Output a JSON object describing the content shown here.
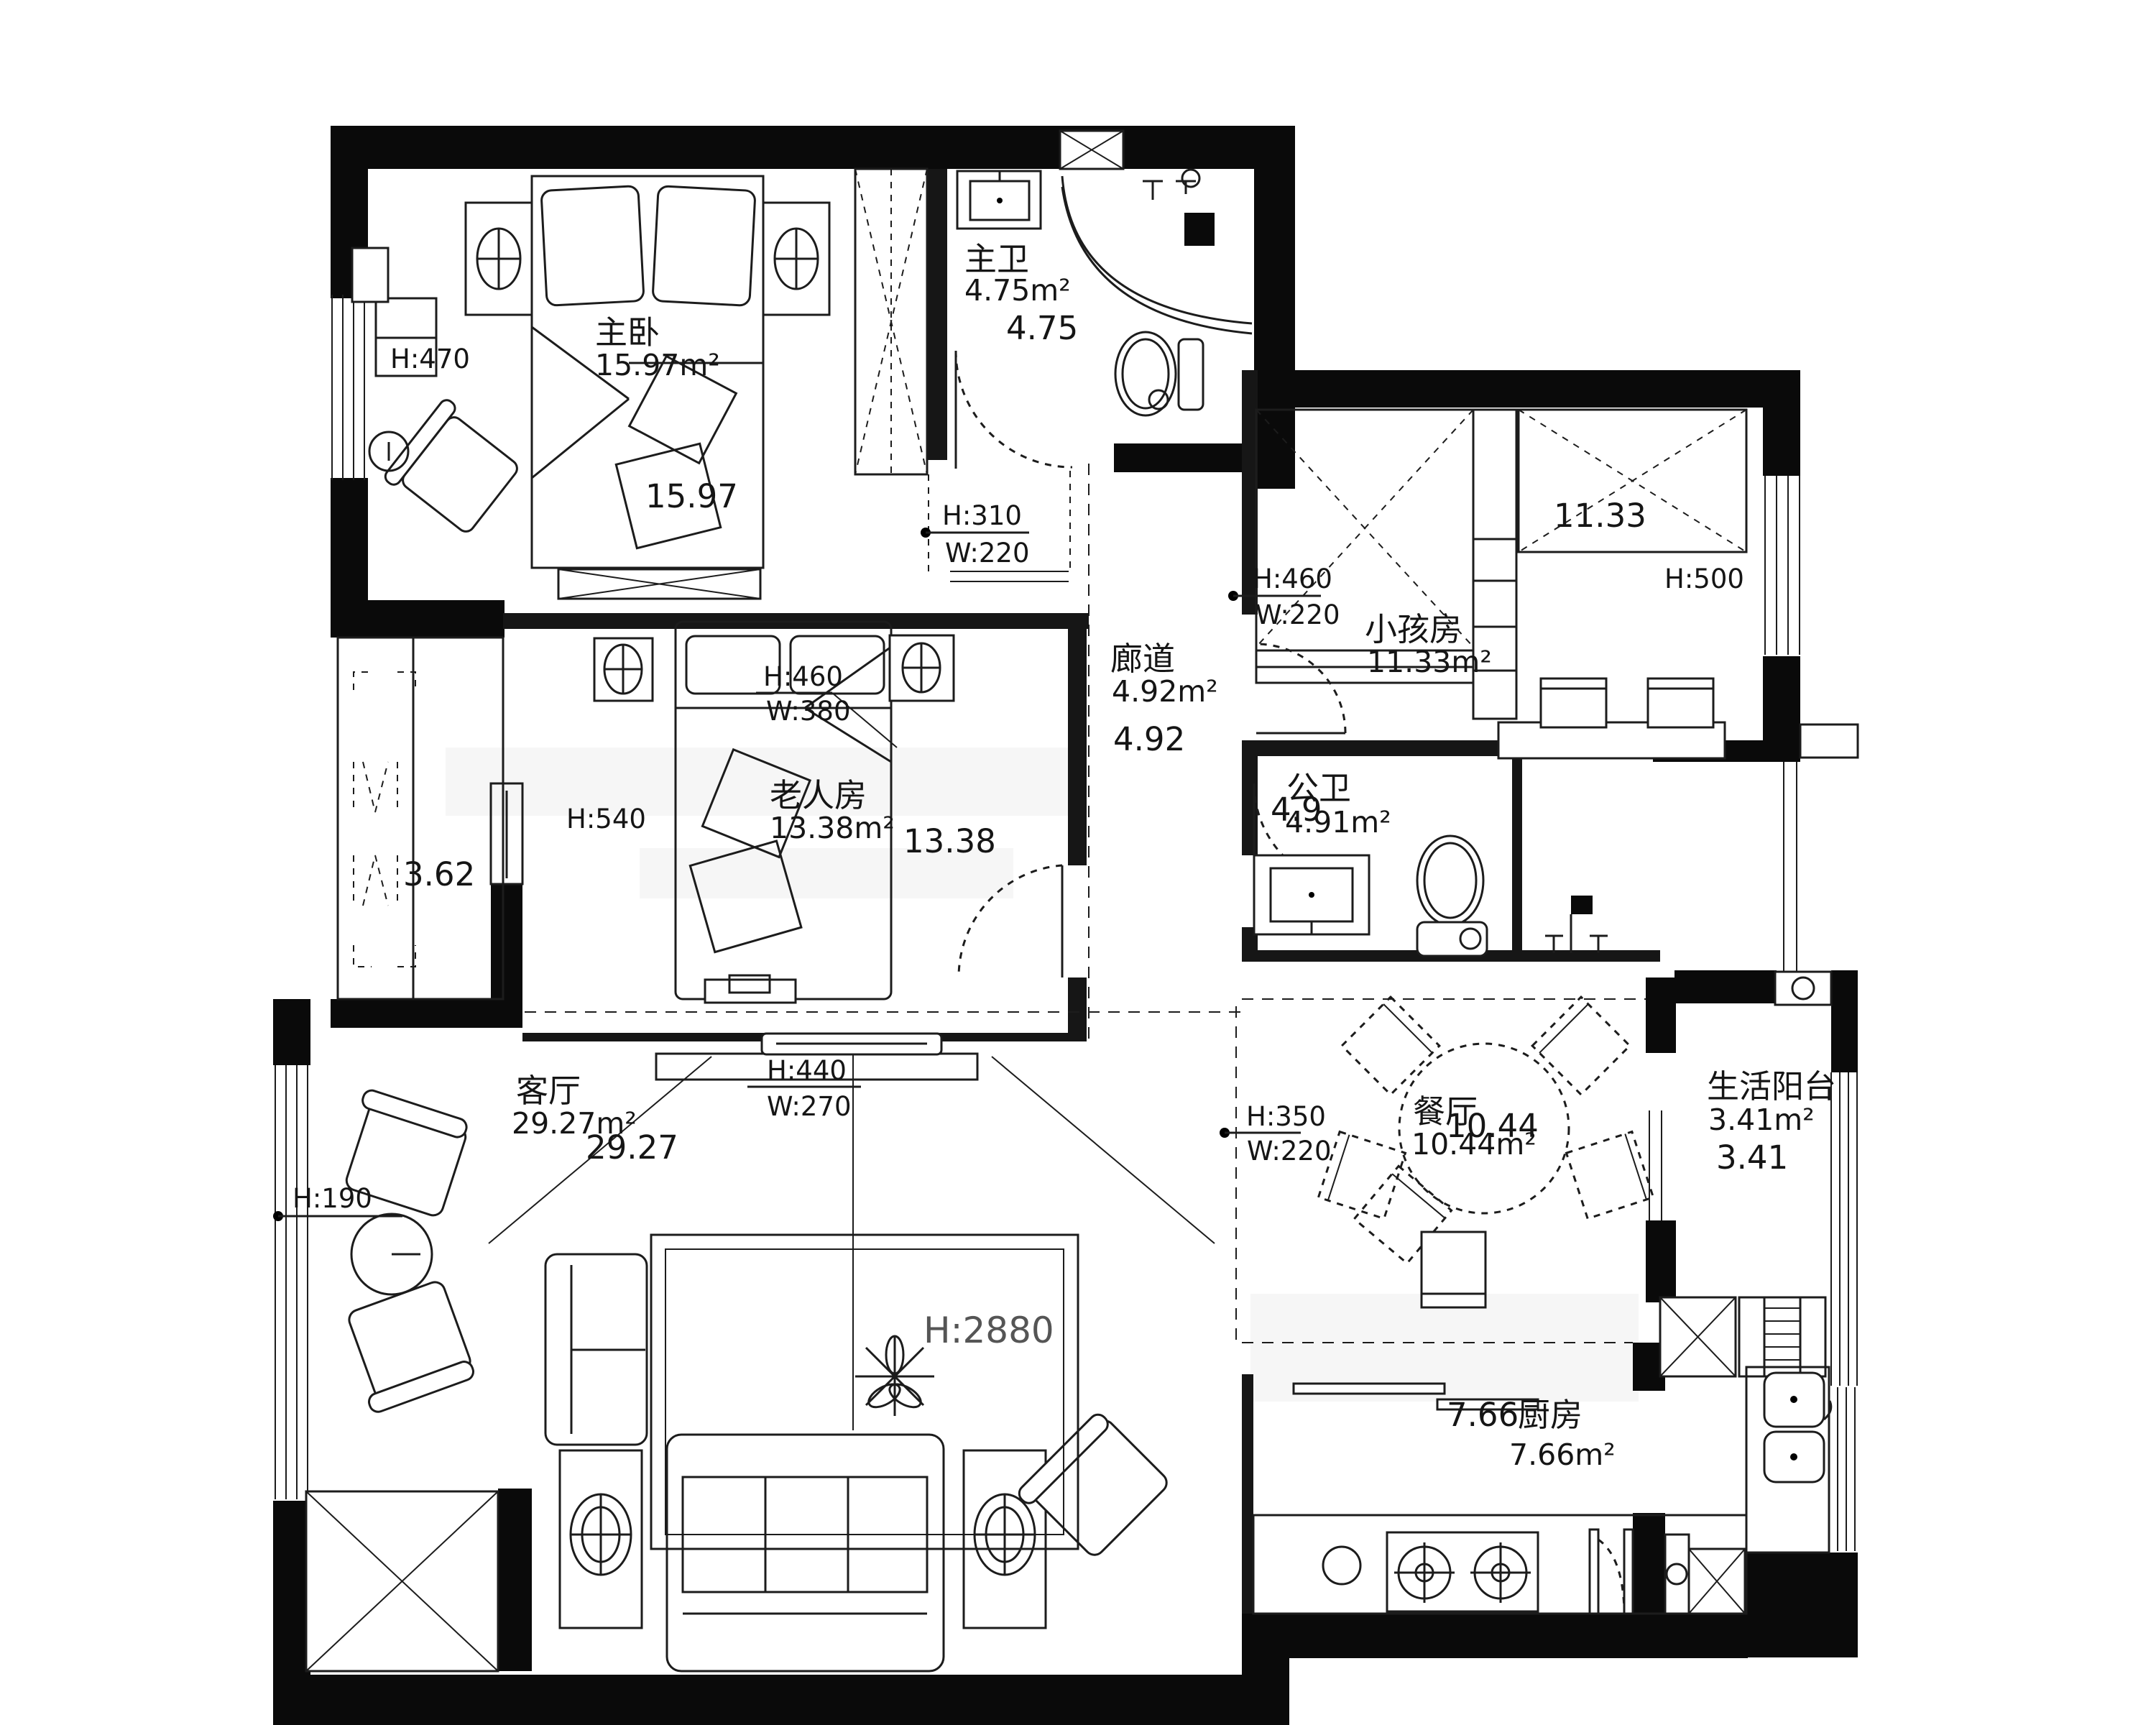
{
  "plan": {
    "rooms": {
      "master_bedroom": {
        "label": "主卧",
        "area": "15.97m²",
        "dim": "15.97"
      },
      "master_bath": {
        "label": "主卫",
        "area": "4.75m²",
        "dim": "4.75"
      },
      "kids_room": {
        "label": "小孩房",
        "area": "11.33m²",
        "dim": "11.33"
      },
      "corridor": {
        "label": "廊道",
        "area": "4.92m²",
        "dim": "4.92"
      },
      "elder_room": {
        "label": "老人房",
        "area": "13.38m²",
        "dim": "13.38"
      },
      "public_bath": {
        "label": "公卫",
        "area": "4.91m²",
        "dim": "4.9"
      },
      "dining": {
        "label": "餐厅",
        "area": "10.44m²",
        "dim": "10.44"
      },
      "balcony": {
        "label": "生活阳台",
        "area": "3.41m²",
        "dim": "3.41"
      },
      "kitchen": {
        "label": "厨房",
        "area": "7.66m²",
        "dim": "7.66"
      },
      "living": {
        "label": "客厅",
        "area": "29.27m²",
        "dim": "29.27"
      },
      "closet": {
        "dim": "3.62"
      }
    },
    "annotations": {
      "master_bedroom_height": {
        "h": "H:470"
      },
      "elder_room_height": {
        "h": "H:540"
      },
      "kids_room_height": {
        "h": "H:500"
      },
      "living_ceiling": {
        "h": "H:2880"
      },
      "living_window": {
        "h": "H:190"
      },
      "corridor_top": {
        "h": "H:310",
        "w": "W:220"
      },
      "kids_door": {
        "h": "H:460",
        "w": "W:220"
      },
      "elder_bed": {
        "h": "H:460",
        "w": "W:380"
      },
      "tv_wall": {
        "h": "H:440",
        "w": "W:270"
      },
      "dining_opening": {
        "h": "H:350",
        "w": "W:220"
      }
    }
  }
}
